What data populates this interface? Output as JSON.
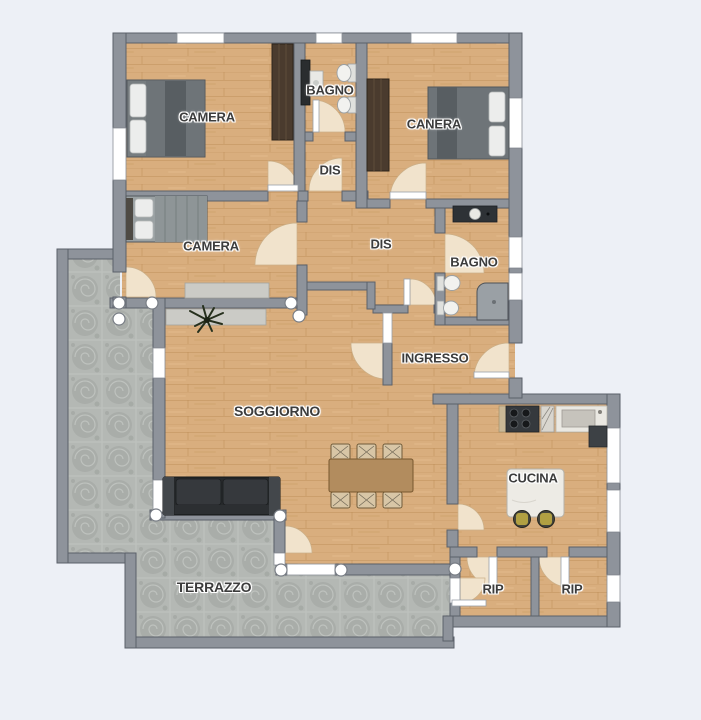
{
  "page": {
    "background": "#edf0f6",
    "type": "apartment-floor-plan"
  },
  "colors": {
    "wall": "#8e939b",
    "wall_outline": "#5b606a",
    "wood_floor": "#d9ae7e",
    "stone_floor": "#b4b8b4",
    "door_arc": "#f1e3cc",
    "window": "#ffffff",
    "label_text": "#3c3c3c",
    "sofa": "#26292b",
    "stool_seat": "#b1a042"
  },
  "rooms": [
    {
      "id": "camera-1",
      "label": "CAMERA",
      "x": 207,
      "y": 117
    },
    {
      "id": "bagno-1",
      "label": "BAGNO",
      "x": 330,
      "y": 90
    },
    {
      "id": "canera",
      "label": "CANERA",
      "x": 434,
      "y": 124
    },
    {
      "id": "dis-1",
      "label": "DIS",
      "x": 330,
      "y": 170
    },
    {
      "id": "camera-2",
      "label": "CAMERA",
      "x": 211,
      "y": 246
    },
    {
      "id": "dis-2",
      "label": "DIS",
      "x": 381,
      "y": 244
    },
    {
      "id": "bagno-2",
      "label": "BAGNO",
      "x": 474,
      "y": 262
    },
    {
      "id": "ingresso",
      "label": "INGRESSO",
      "x": 435,
      "y": 358
    },
    {
      "id": "soggiorno",
      "label": "SOGGIORNO",
      "x": 277,
      "y": 411
    },
    {
      "id": "cucina",
      "label": "CUCINA",
      "x": 533,
      "y": 478
    },
    {
      "id": "rip-1",
      "label": "RIP",
      "x": 493,
      "y": 589
    },
    {
      "id": "rip-2",
      "label": "RIP",
      "x": 572,
      "y": 589
    },
    {
      "id": "terrazzo",
      "label": "TERRAZZO",
      "x": 214,
      "y": 587
    }
  ],
  "furniture": [
    "double-bed",
    "double-bed",
    "double-bed",
    "wardrobe",
    "wardrobe",
    "sofa",
    "dining-table",
    "dining-chairs",
    "sideboard",
    "console",
    "plant",
    "kitchen-counter",
    "stove",
    "kitchen-sink",
    "fridge",
    "kitchen-island",
    "bar-stools",
    "washbasin",
    "toilet",
    "bidet",
    "shower",
    "bathroom-counter"
  ]
}
